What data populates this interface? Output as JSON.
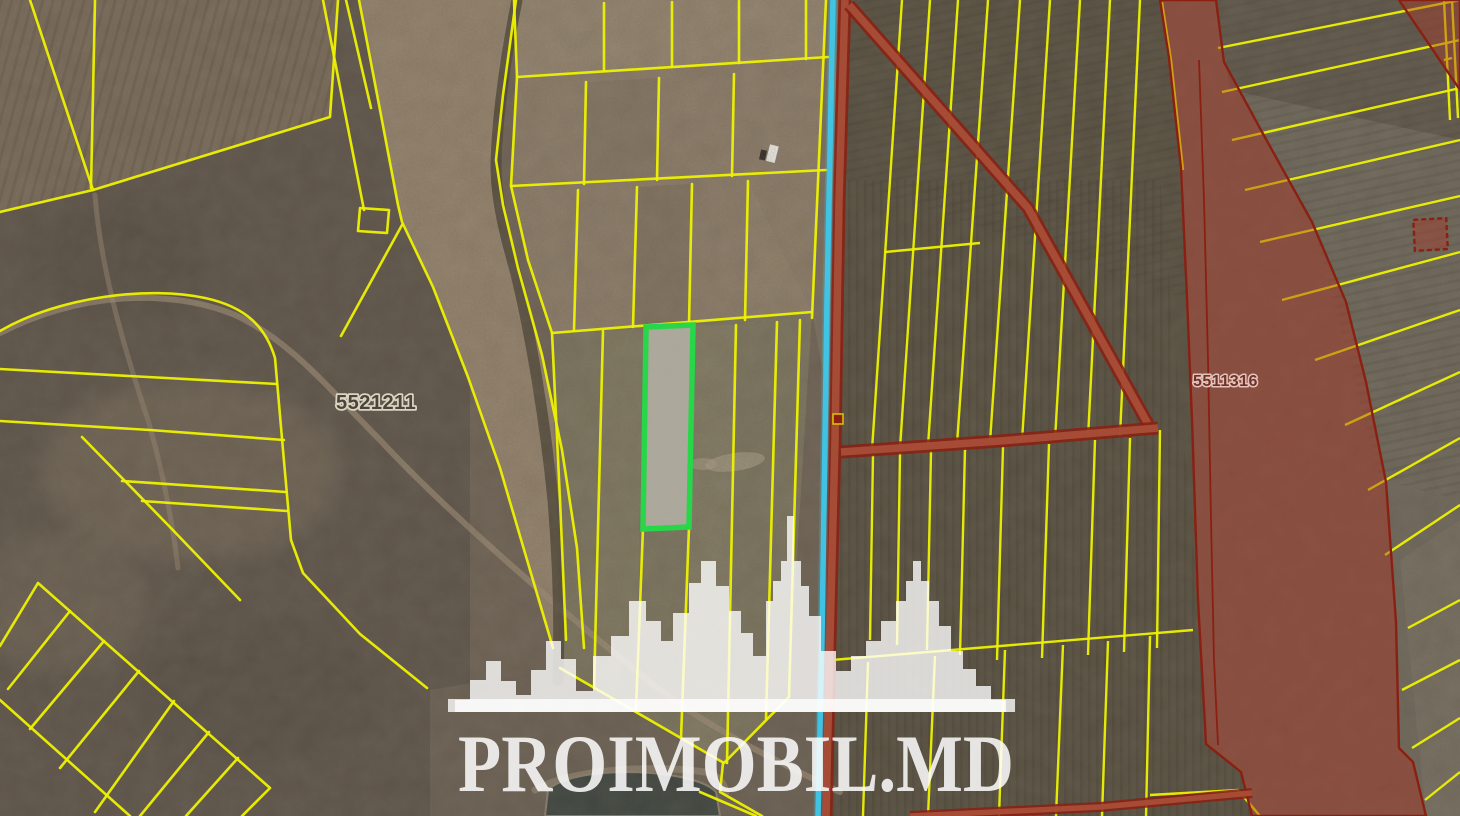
{
  "map": {
    "watermark_text": "PROIMOBIL.MD",
    "labels": {
      "parcel_left_number": "5521211",
      "parcel_right_number": "5511316"
    },
    "colors": {
      "cadastral_line": "#eef200",
      "selected_parcel": "#27d649",
      "selected_parcel_fill": "#b5b2a6",
      "restricted_stroke": "#8a2012",
      "restricted_fill": "rgba(172,58,40,0.42)",
      "restricted_road_fill": "#a8503a",
      "utility_line": "#3fc6e8",
      "water_fill": "#39423c",
      "watermark_color": "#ffffff",
      "label_dark": "#4b443c",
      "label_halo": "#dcd3c1",
      "label_red": "#71302a",
      "label_red_halo": "#e4c4ba"
    }
  }
}
